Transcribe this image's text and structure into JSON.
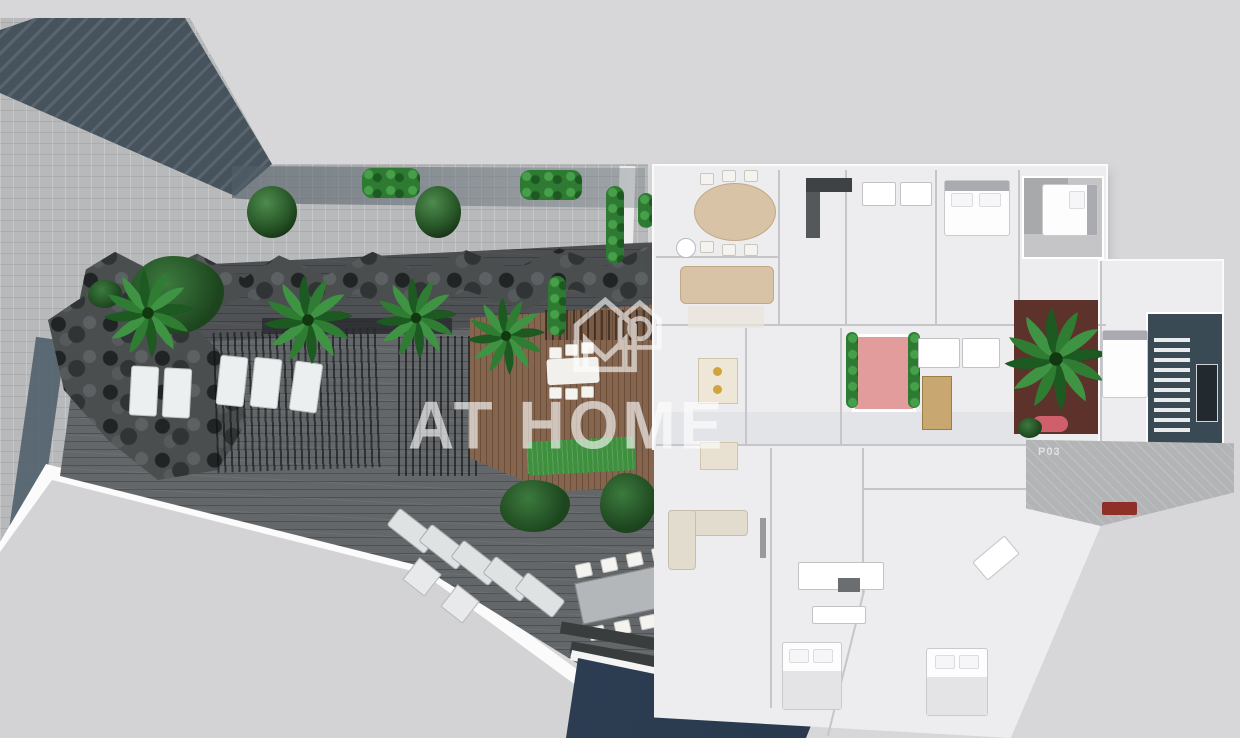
{
  "watermark": {
    "brand": "AT HOME",
    "logo_icon": "house-with-m-logo-icon",
    "color": "#ffffff"
  },
  "labels": {
    "plot_label": "P03"
  },
  "icons": {
    "logo": "house-with-m-logo-icon",
    "palm": "palm-tree-icon",
    "bush": "round-bush-icon"
  },
  "palette": {
    "background": "#d7d7d9",
    "pavement": "#b7b9ba",
    "shadow_band": "#46535d",
    "deck_gray": "#64676a",
    "deck_wood": "#85654e",
    "palm_green": "#2e7d32",
    "lawn_green": "#3e8f3e",
    "plan_floor": "#ededef",
    "plan_wall": "#c5c5ca",
    "courtyard_pink": "#e29c9c",
    "planter_maroon": "#5c322b",
    "stairwell_navy": "#3a4a55",
    "pool_navy": "#243246",
    "furniture_beige": "#d8c3a6",
    "accent_red": "#8e2f28",
    "watermark": "#ffffff"
  }
}
